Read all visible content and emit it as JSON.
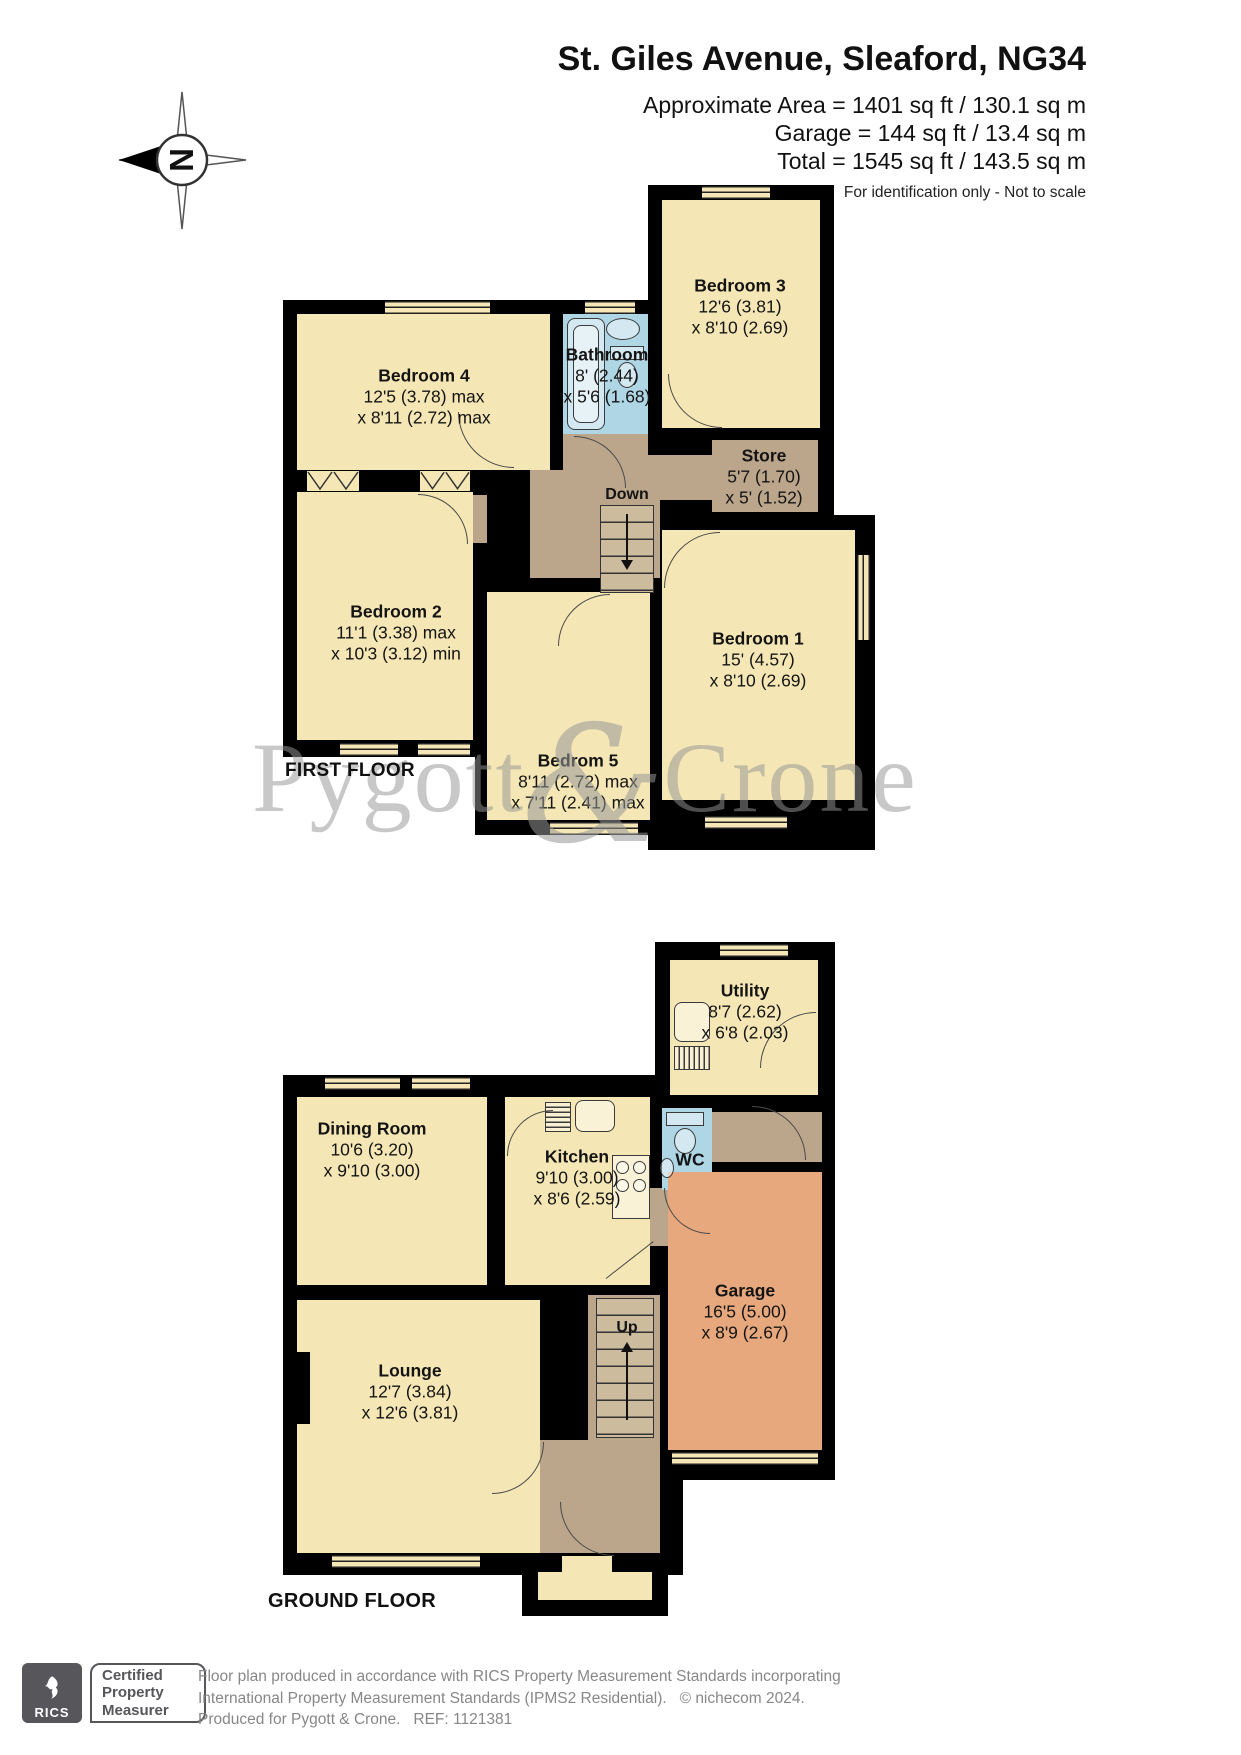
{
  "header": {
    "title": "St. Giles Avenue, Sleaford, NG34",
    "area_lines": [
      "Approximate Area = 1401 sq ft / 130.1 sq m",
      "Garage = 144 sq ft / 13.4 sq m",
      "Total = 1545 sq ft / 143.5 sq m"
    ],
    "disclaimer": "For identification only - Not to scale"
  },
  "compass": {
    "north_label": "N"
  },
  "watermark": {
    "left": "Pygott",
    "ampersand": "&",
    "right": "Crone"
  },
  "floors": {
    "first": {
      "label": "FIRST FLOOR",
      "stairs": "Down",
      "rooms": {
        "bedroom4": {
          "name": "Bedroom 4",
          "dim1": "12'5 (3.78) max",
          "dim2": "x 8'11 (2.72) max"
        },
        "bathroom": {
          "name": "Bathroom",
          "dim1": "8' (2.44)",
          "dim2": "x 5'6 (1.68)"
        },
        "bedroom3": {
          "name": "Bedroom 3",
          "dim1": "12'6 (3.81)",
          "dim2": "x 8'10 (2.69)"
        },
        "store": {
          "name": "Store",
          "dim1": "5'7 (1.70)",
          "dim2": "x 5' (1.52)"
        },
        "bedroom2": {
          "name": "Bedroom 2",
          "dim1": "11'1 (3.38) max",
          "dim2": "x 10'3 (3.12) min"
        },
        "bedroom5": {
          "name": "Bedrom 5",
          "dim1": "8'11 (2.72) max",
          "dim2": "x 7'11 (2.41) max"
        },
        "bedroom1": {
          "name": "Bedroom 1",
          "dim1": "15' (4.57)",
          "dim2": "x 8'10 (2.69)"
        }
      }
    },
    "ground": {
      "label": "GROUND FLOOR",
      "stairs": "Up",
      "rooms": {
        "utility": {
          "name": "Utility",
          "dim1": "8'7 (2.62)",
          "dim2": "x 6'8 (2.03)"
        },
        "dining": {
          "name": "Dining Room",
          "dim1": "10'6 (3.20)",
          "dim2": "x 9'10 (3.00)"
        },
        "kitchen": {
          "name": "Kitchen",
          "dim1": "9'10 (3.00)",
          "dim2": "x 8'6 (2.59)"
        },
        "wc": {
          "name": "WC"
        },
        "lounge": {
          "name": "Lounge",
          "dim1": "12'7 (3.84)",
          "dim2": "x 12'6 (3.81)"
        },
        "garage": {
          "name": "Garage",
          "dim1": "16'5 (5.00)",
          "dim2": "x 8'9 (2.67)"
        }
      }
    }
  },
  "footer": {
    "rics_label": "RICS",
    "badge": [
      "Certified",
      "Property",
      "Measurer"
    ],
    "lines": [
      "Floor plan produced in accordance with RICS Property Measurement Standards incorporating",
      "International Property Measurement Standards (IPMS2 Residential).   © nichecom 2024.",
      "Produced for Pygott & Crone.   REF: 1121381"
    ]
  },
  "colors": {
    "room_fill": "#F5E7B5",
    "wet_room_fill": "#AFD6E4",
    "hall_fill": "#BBA58B",
    "garage_fill": "#E8A87E",
    "wall": "#000000",
    "watermark": "#969696",
    "footer_text": "#878787",
    "rics_box": "#57575B"
  }
}
